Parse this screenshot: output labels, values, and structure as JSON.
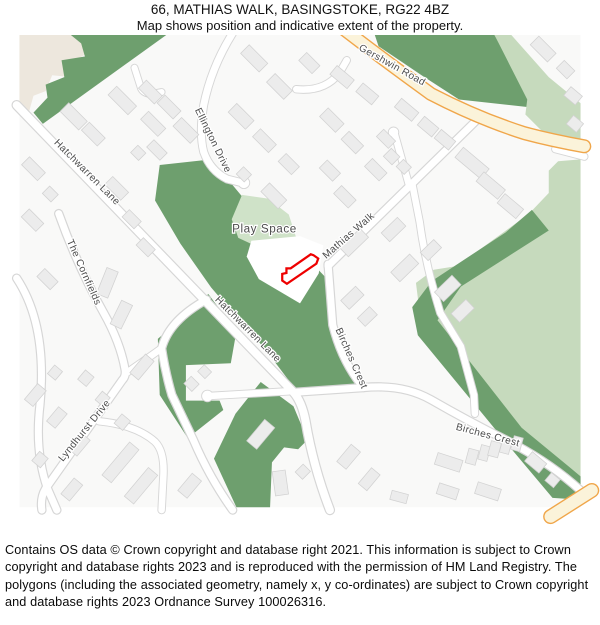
{
  "header": {
    "title": "66, MATHIAS WALK, BASINGSTOKE, RG22 4BZ",
    "subtitle": "Map shows position and indicative extent of the property."
  },
  "map": {
    "labels": {
      "gershwin_road": "Gershwin Road",
      "hatchwarren_lane_upper": "Hatchwarren Lane",
      "hatchwarren_lane_lower": "Hatchwarren Lane",
      "ellington_drive": "Ellington Drive",
      "mathias_walk": "Mathias Walk",
      "play_space": "Play Space",
      "the_cornfields": "The Cornfields",
      "lyndhurst_drive": "Lyndhurst Drive",
      "birches_crest_upper": "Birches Crest",
      "birches_crest_lower": "Birches Crest"
    },
    "colors": {
      "background": "#f9f9f8",
      "woodland_green": "#6e9f6e",
      "grass_green": "#c6dabd",
      "play_space_green": "#cfe2c8",
      "residential_beige": "#ede7dd",
      "building_fill": "#ececec",
      "building_stroke": "#d2d2d2",
      "road_fill": "#ffffff",
      "road_casing": "#d6d6d6",
      "primary_road_fill": "#fbf3da",
      "primary_road_casing": "#f0a64a",
      "property_outline_red": "#ee0000",
      "label_gray": "#4d4d4d"
    }
  },
  "footer": {
    "copyright": "Contains OS data © Crown copyright and database right 2021. This information is subject to Crown copyright and database rights 2023 and is reproduced with the permission of HM Land Registry. The polygons (including the associated geometry, namely x, y co-ordinates) are subject to Crown copyright and database rights 2023 Ordnance Survey 100026316."
  }
}
